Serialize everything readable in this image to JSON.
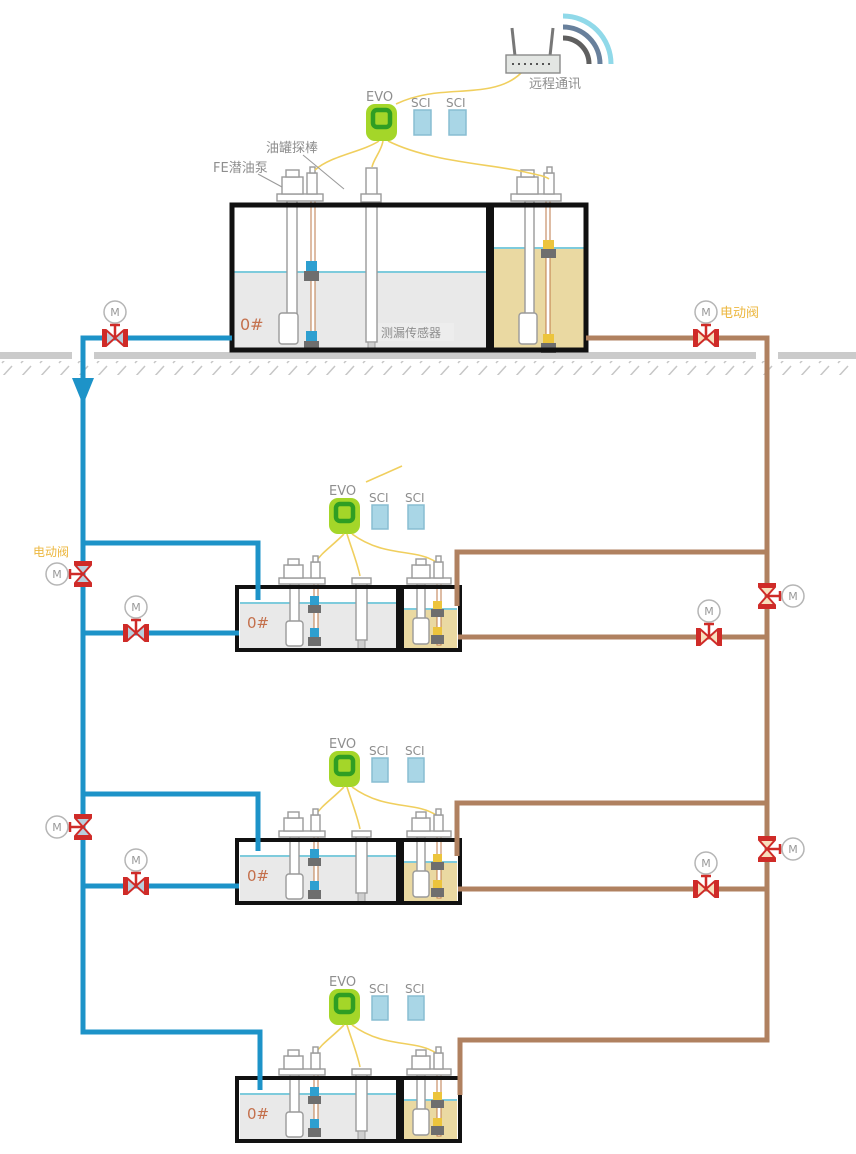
{
  "page": {
    "background": "#ffffff"
  },
  "labels": {
    "remote_comm": "远程通讯",
    "evo": "EVO",
    "sci": "SCI",
    "tank_probe": "油罐探棒",
    "fe_pump": "FE潜油泵",
    "leak_sensor": "测漏传感器",
    "electric_valve": "电动阀",
    "fuel_grade": "0#",
    "motor": "M"
  },
  "colors": {
    "pipe_blue": "#1d93c8",
    "pipe_brown": "#b08160",
    "wire_yellow": "#f0cf5e",
    "valve_red": "#cf2b28",
    "valve_disc_blue": "#b9cfdd",
    "valve_disc_tan": "#f8dfbd",
    "evo_body_green": "#a4d629",
    "evo_square_green": "#2f9e23",
    "sci_module_blue": "#a9d6e6",
    "fluid_diesel_gray": "#e9e9e9",
    "fluid_gasoline_tan": "#ead9a2",
    "liquid_surface_cyan": "#7ecbdc",
    "ground_gray": "#cbcbcb",
    "label_gray": "#8e8e8e",
    "electric_valve_label_orange": "#ecb73f",
    "fuel_grade_rust": "#c4704c",
    "wifi_arc_outer": "#90d9e9",
    "wifi_arc_middle": "#68809c",
    "wifi_arc_inner": "#5f5f5f"
  }
}
